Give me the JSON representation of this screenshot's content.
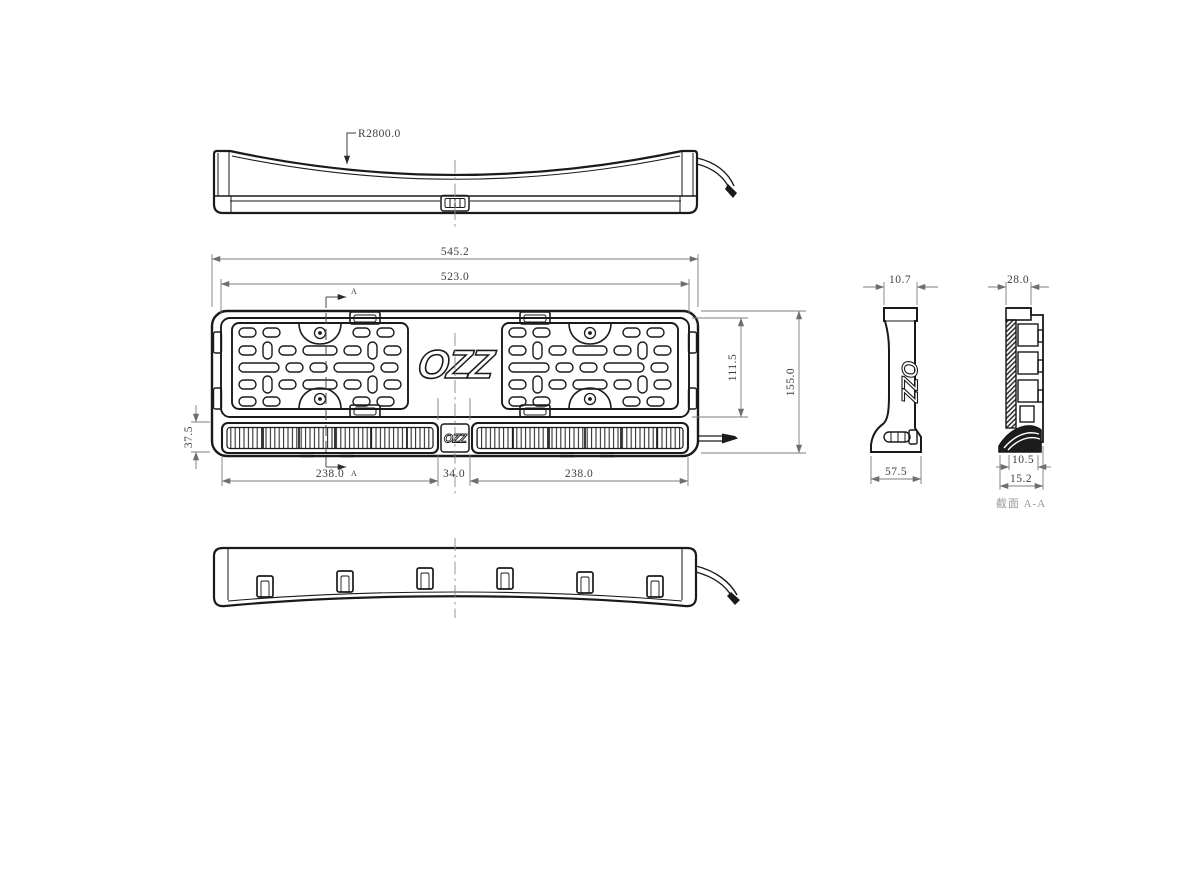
{
  "drawing": {
    "radius_label": "R2800.0",
    "logo_front": "OZZ",
    "logo_strip": "OZZ",
    "logo_side": "OZZ",
    "section_marker_top": "A",
    "section_marker_bottom": "A",
    "section_label": "截面 A-A",
    "dims": {
      "overall_width": "545.2",
      "plate_window_width": "523.0",
      "plate_window_height": "111.5",
      "overall_height": "155.0",
      "led_strip_height": "37.5",
      "led_left_width": "238.0",
      "center_gap_width": "34.0",
      "led_right_width": "238.0",
      "side_top_thickness": "10.7",
      "side_bottom_depth": "57.5",
      "section_top_width": "28.0",
      "section_inner_width": "10.5",
      "section_bottom_width": "15.2"
    },
    "colors": {
      "line": "#1a1a1a",
      "dimension": "#7d7d7d",
      "background": "#ffffff"
    }
  }
}
